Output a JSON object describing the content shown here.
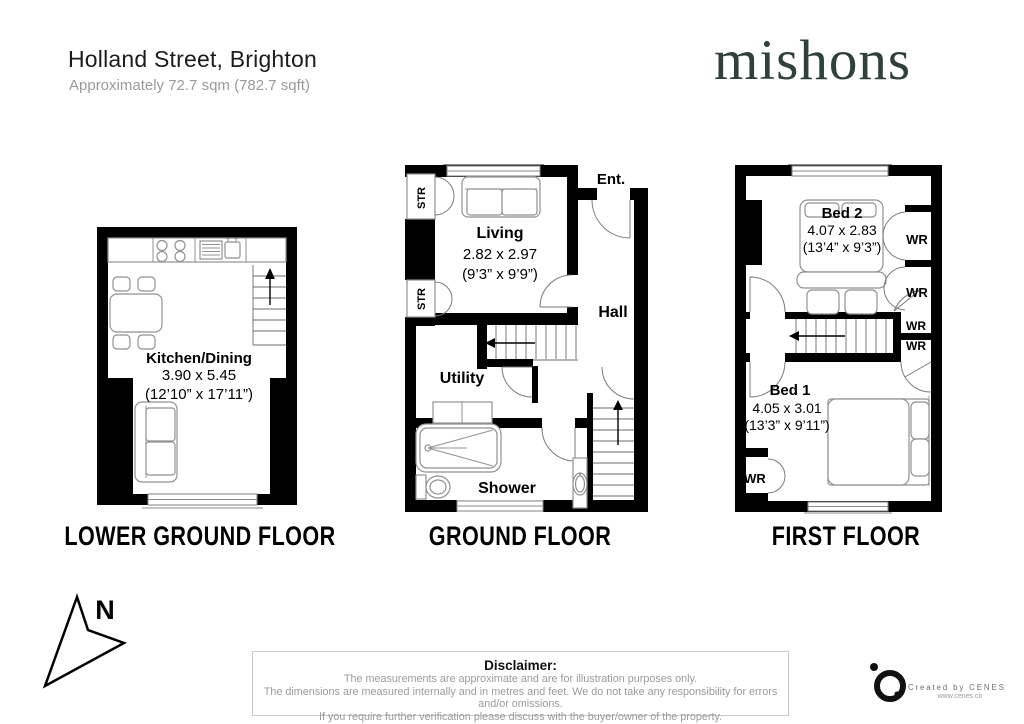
{
  "header": {
    "title": "Holland Street, Brighton",
    "subtitle": "Approximately 72.7 sqm (782.7 sqft)"
  },
  "brand": {
    "name": "mishons",
    "color": "#2F4138"
  },
  "floors": [
    {
      "id": "lower-ground",
      "label": "LOWER GROUND FLOOR",
      "rooms": {
        "kitchen_dining": {
          "name": "Kitchen/Dining",
          "metric": "3.90 x 5.45",
          "imperial": "(12’10” x 17’11”)"
        }
      }
    },
    {
      "id": "ground",
      "label": "GROUND FLOOR",
      "storage_label": "STR",
      "rooms": {
        "living": {
          "name": "Living",
          "metric": "2.82 x 2.97",
          "imperial": "(9’3” x 9’9”)"
        },
        "entrance": {
          "name": "Ent."
        },
        "hall": {
          "name": "Hall"
        },
        "utility": {
          "name": "Utility"
        },
        "shower": {
          "name": "Shower"
        }
      }
    },
    {
      "id": "first",
      "label": "FIRST FLOOR",
      "wardrobe_label": "WR",
      "rooms": {
        "bed2": {
          "name": "Bed 2",
          "metric": "4.07 x 2.83",
          "imperial": "(13’4” x 9’3”)"
        },
        "bed1": {
          "name": "Bed 1",
          "metric": "4.05 x 3.01",
          "imperial": "(13’3” x 9’11”)"
        }
      }
    }
  ],
  "compass": {
    "label": "N"
  },
  "disclaimer": {
    "title": "Disclaimer:",
    "lines": [
      "The measurements are approximate and are for illustration purposes only.",
      "The dimensions are measured internally and in metres and feet. We do not take any responsibility for errors and/or omissions.",
      "If you require further verification please discuss with the buyer/owner of the property."
    ]
  },
  "credit": {
    "line1": "Created by CENES",
    "line2": "www.cenes.co"
  }
}
